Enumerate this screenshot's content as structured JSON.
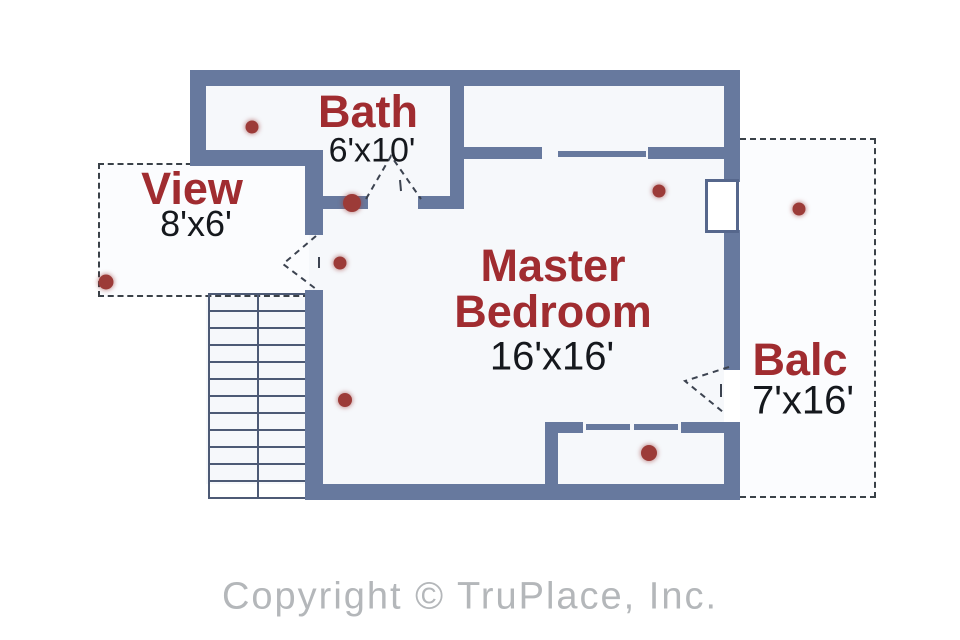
{
  "floorplan": {
    "rooms": {
      "bath": {
        "name": "Bath",
        "dims": "6'x10'"
      },
      "view": {
        "name": "View",
        "dims": "8'x6'"
      },
      "master": {
        "name": "Master Bedroom",
        "dims": "16'x16'"
      },
      "balcony": {
        "name": "Balc",
        "dims": "7'x16'"
      }
    },
    "colors": {
      "wall": "#67799e",
      "room_label": "#a02c30",
      "dimension_text": "#15181d",
      "hotspot": "#9c3b38",
      "door_swing": "#3c4350",
      "copyright_text": "#b4b7ba"
    },
    "hotspots": [
      {
        "x": 252,
        "y": 127,
        "size": 13
      },
      {
        "x": 352,
        "y": 203,
        "size": 18
      },
      {
        "x": 340,
        "y": 263,
        "size": 13
      },
      {
        "x": 659,
        "y": 191,
        "size": 13
      },
      {
        "x": 799,
        "y": 209,
        "size": 13
      },
      {
        "x": 345,
        "y": 400,
        "size": 14
      },
      {
        "x": 649,
        "y": 453,
        "size": 16
      },
      {
        "x": 106,
        "y": 282,
        "size": 15
      }
    ]
  },
  "footer": {
    "copyright": "Copyright © TruPlace, Inc."
  }
}
